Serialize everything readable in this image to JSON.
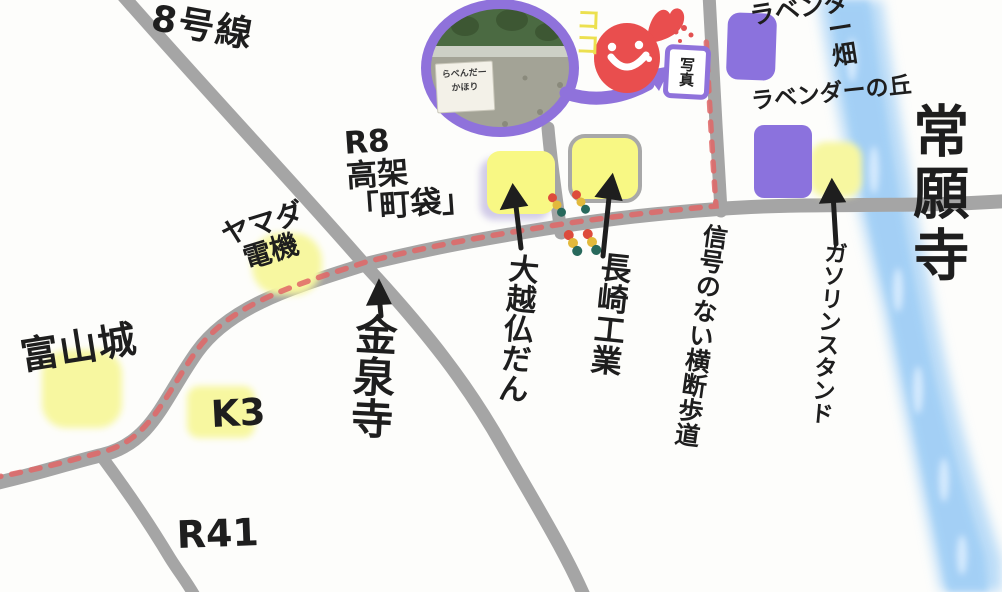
{
  "map": {
    "destination": {
      "here_marker": "ココ",
      "photo_frame_label": "写真",
      "photo_sign_line1": "らべんだー",
      "photo_sign_line2": "かほり"
    },
    "roads": {
      "route8": "8号線",
      "r8_overpass": "R8\n高架\n「町袋」",
      "k3": "K3",
      "r41": "R41"
    },
    "places": {
      "yamada_denki": "ヤマダ\n電機",
      "kinsenji": "金泉寺",
      "okoshi_butsudan": "大越仏だん",
      "nagasaki_kogyo": "長崎工業",
      "crosswalk_no_signal": "信号のない横断歩道",
      "gas_station": "ガソリンスタンド",
      "lavender_field": "ラベンダー\n畑",
      "lavender_hill": "ラベンダーの丘",
      "joganji": "常願寺",
      "toyama_castle": "富山城"
    },
    "colors": {
      "road_gray": "#a5a5a5",
      "route_dash_red": "#e06666",
      "highlight_yellow": "#f8f884",
      "lavender_purple": "#8b72dd",
      "river_blue": "#aed6f7",
      "mascot_red": "#e94e4e",
      "here_yellow": "#ece04f"
    }
  }
}
